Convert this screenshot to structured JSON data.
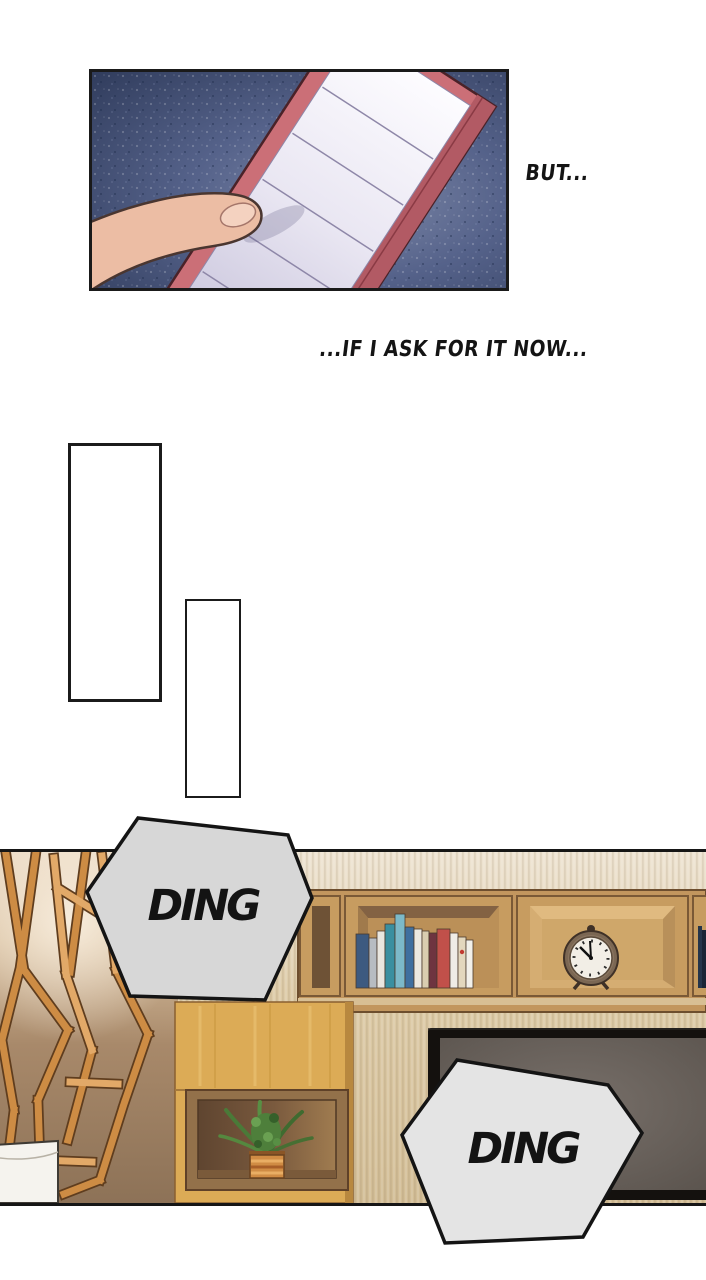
{
  "comic": {
    "narration": [
      {
        "id": "but",
        "text": "BUT..."
      },
      {
        "id": "ask-now",
        "text": "...IF I ASK FOR IT NOW..."
      }
    ],
    "sfx": [
      {
        "id": "ding-1",
        "text": "DING"
      },
      {
        "id": "ding-2",
        "text": "DING"
      }
    ],
    "objects": {
      "alarm_clock_time_approx": "10:55"
    },
    "colors": {
      "sfx_bubble_1": "#d7d7d7",
      "sfx_bubble_2": "#e4e4e4",
      "outline_black": "#141414",
      "notepad_cover": "#cb6f77",
      "notepad_paper": "#f1eff6",
      "panel1_background": "#42507a",
      "wallpaper_beige": "#e4d6bd",
      "wood_orange": "#cd8c44",
      "cabinet_gold": "#dcab56",
      "tv_screen_gray": "#6e6660",
      "plant_green": "#4e7f3b"
    }
  }
}
